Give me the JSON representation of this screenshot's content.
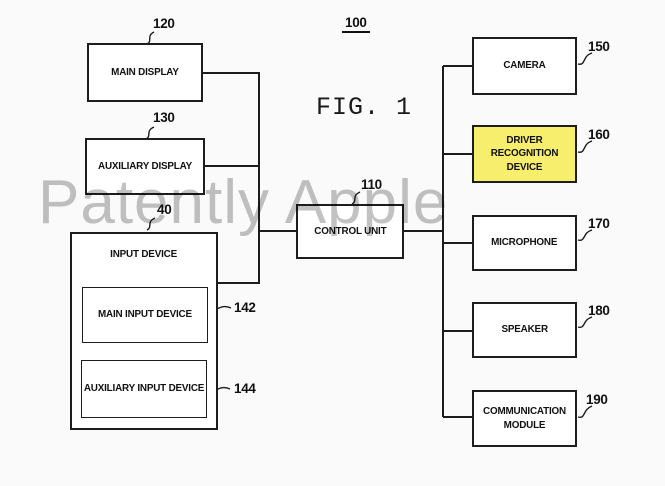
{
  "figure": {
    "ref_number": "100",
    "caption": "FIG. 1",
    "watermark": "Patently Apple"
  },
  "blocks": {
    "main_display": {
      "label": "MAIN DISPLAY",
      "ref": "120"
    },
    "auxiliary_display": {
      "label": "AUXILIARY DISPLAY",
      "ref": "130"
    },
    "input_device": {
      "label": "INPUT DEVICE",
      "ref": "40"
    },
    "main_input_device": {
      "label": "MAIN INPUT DEVICE",
      "ref": "142"
    },
    "auxiliary_input_device": {
      "label": "AUXILIARY INPUT DEVICE",
      "ref": "144"
    },
    "control_unit": {
      "label": "CONTROL UNIT",
      "ref": "110"
    },
    "camera": {
      "label": "CAMERA",
      "ref": "150"
    },
    "driver_recognition_device": {
      "label": "DRIVER RECOGNITION DEVICE",
      "ref": "160",
      "highlight_color": "#f6ee6c"
    },
    "microphone": {
      "label": "MICROPHONE",
      "ref": "170"
    },
    "speaker": {
      "label": "SPEAKER",
      "ref": "180"
    },
    "communication_module": {
      "label": "COMMUNICATION MODULE",
      "ref": "190"
    }
  },
  "colors": {
    "background": "#fafafa",
    "line": "#1c1c1c",
    "highlight": "#f6ee6c",
    "watermark_gray": "#8f8f8f"
  }
}
